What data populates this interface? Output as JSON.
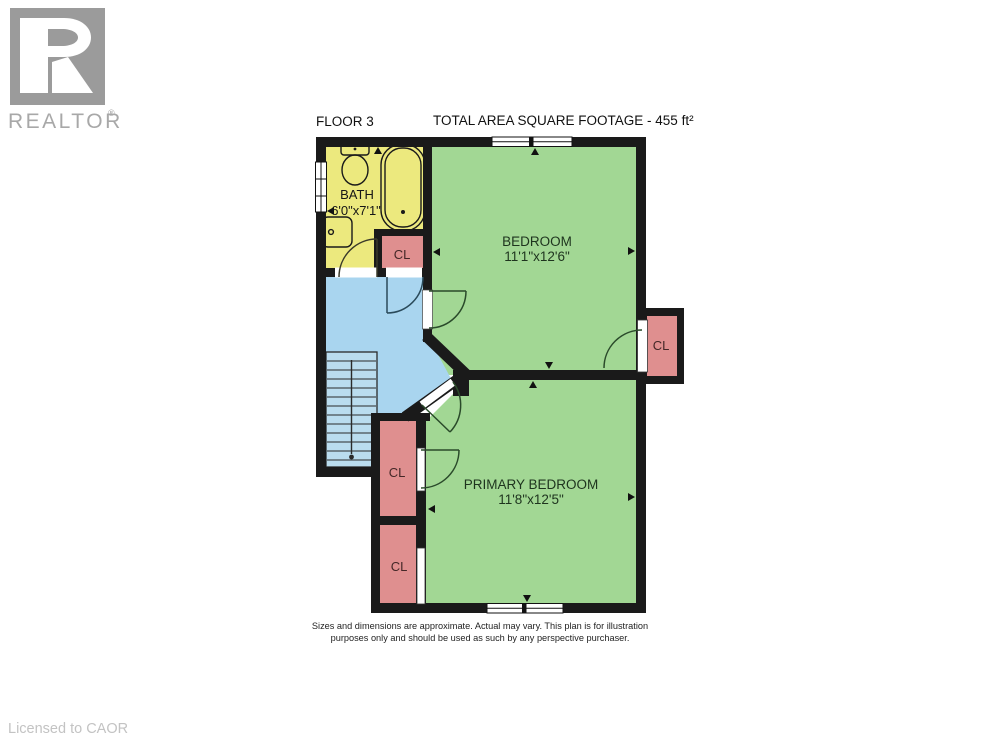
{
  "watermark": {
    "brand": "REALTOR",
    "registered": "®",
    "logo_color": "#9b9b9b",
    "text_color": "#a8a8a8"
  },
  "header": {
    "floor_label": "FLOOR 3",
    "area_label": "TOTAL AREA SQUARE FOOTAGE - 455 ft²"
  },
  "rooms": {
    "bath": {
      "name": "BATH",
      "dims": "6'0\"x7'1\""
    },
    "bedroom": {
      "name": "BEDROOM",
      "dims": "11'1\"x12'6\""
    },
    "primary_bedroom": {
      "name": "PRIMARY BEDROOM",
      "dims": "11'8\"x12'5\""
    },
    "closet_bath": {
      "label": "CL"
    },
    "closet_bedroom": {
      "label": "CL"
    },
    "closet_primary_upper": {
      "label": "CL"
    },
    "closet_primary_lower": {
      "label": "CL"
    }
  },
  "footer": {
    "disclaimer_line1": "Sizes and dimensions are approximate. Actual may vary. This plan is for illustration",
    "disclaimer_line2": "purposes only and should be used as such by any perspective purchaser.",
    "license": "Licensed to CAOR"
  },
  "colors": {
    "bath": "#ece97e",
    "bedroom": "#a2d794",
    "primary": "#a2d794",
    "hall": "#a9d5ef",
    "stairs": "#badcee",
    "closet": "#df8f8f",
    "wall": "#1a1a1a"
  }
}
